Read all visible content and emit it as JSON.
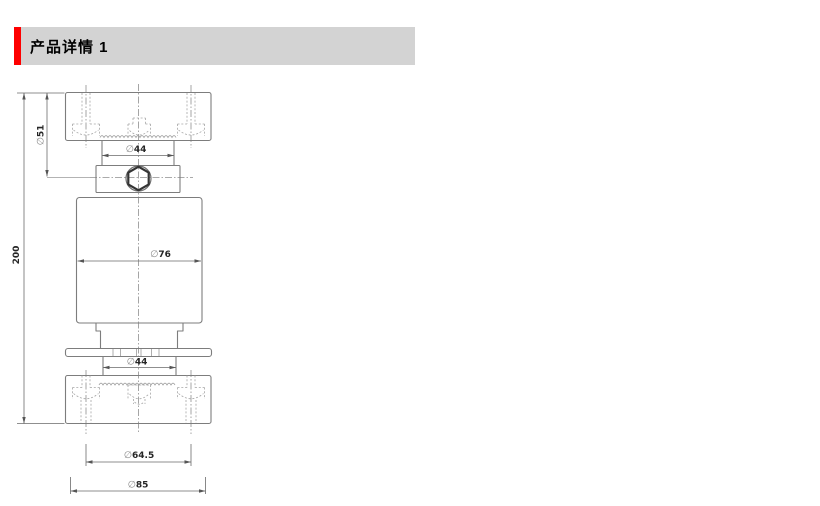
{
  "header": {
    "title": "产品详情 1",
    "accent_color": "#fe0000",
    "band_color": "#d3d3d3"
  },
  "drawing": {
    "description": "Column load cell outline drawing, front view with hidden-line mounting holes",
    "line_color": "#7d7d7d",
    "dimensions": {
      "overall_height": {
        "symbol": "",
        "value": "200"
      },
      "upper_boss": {
        "symbol": "∅",
        "value": "51"
      },
      "upper_neck": {
        "symbol": "∅",
        "value": "44"
      },
      "body": {
        "symbol": "∅",
        "value": "76"
      },
      "lower_neck": {
        "symbol": "∅",
        "value": "44"
      },
      "bolt_circle": {
        "symbol": "∅",
        "value": "64.5"
      },
      "base": {
        "symbol": "∅",
        "value": "85"
      }
    }
  }
}
